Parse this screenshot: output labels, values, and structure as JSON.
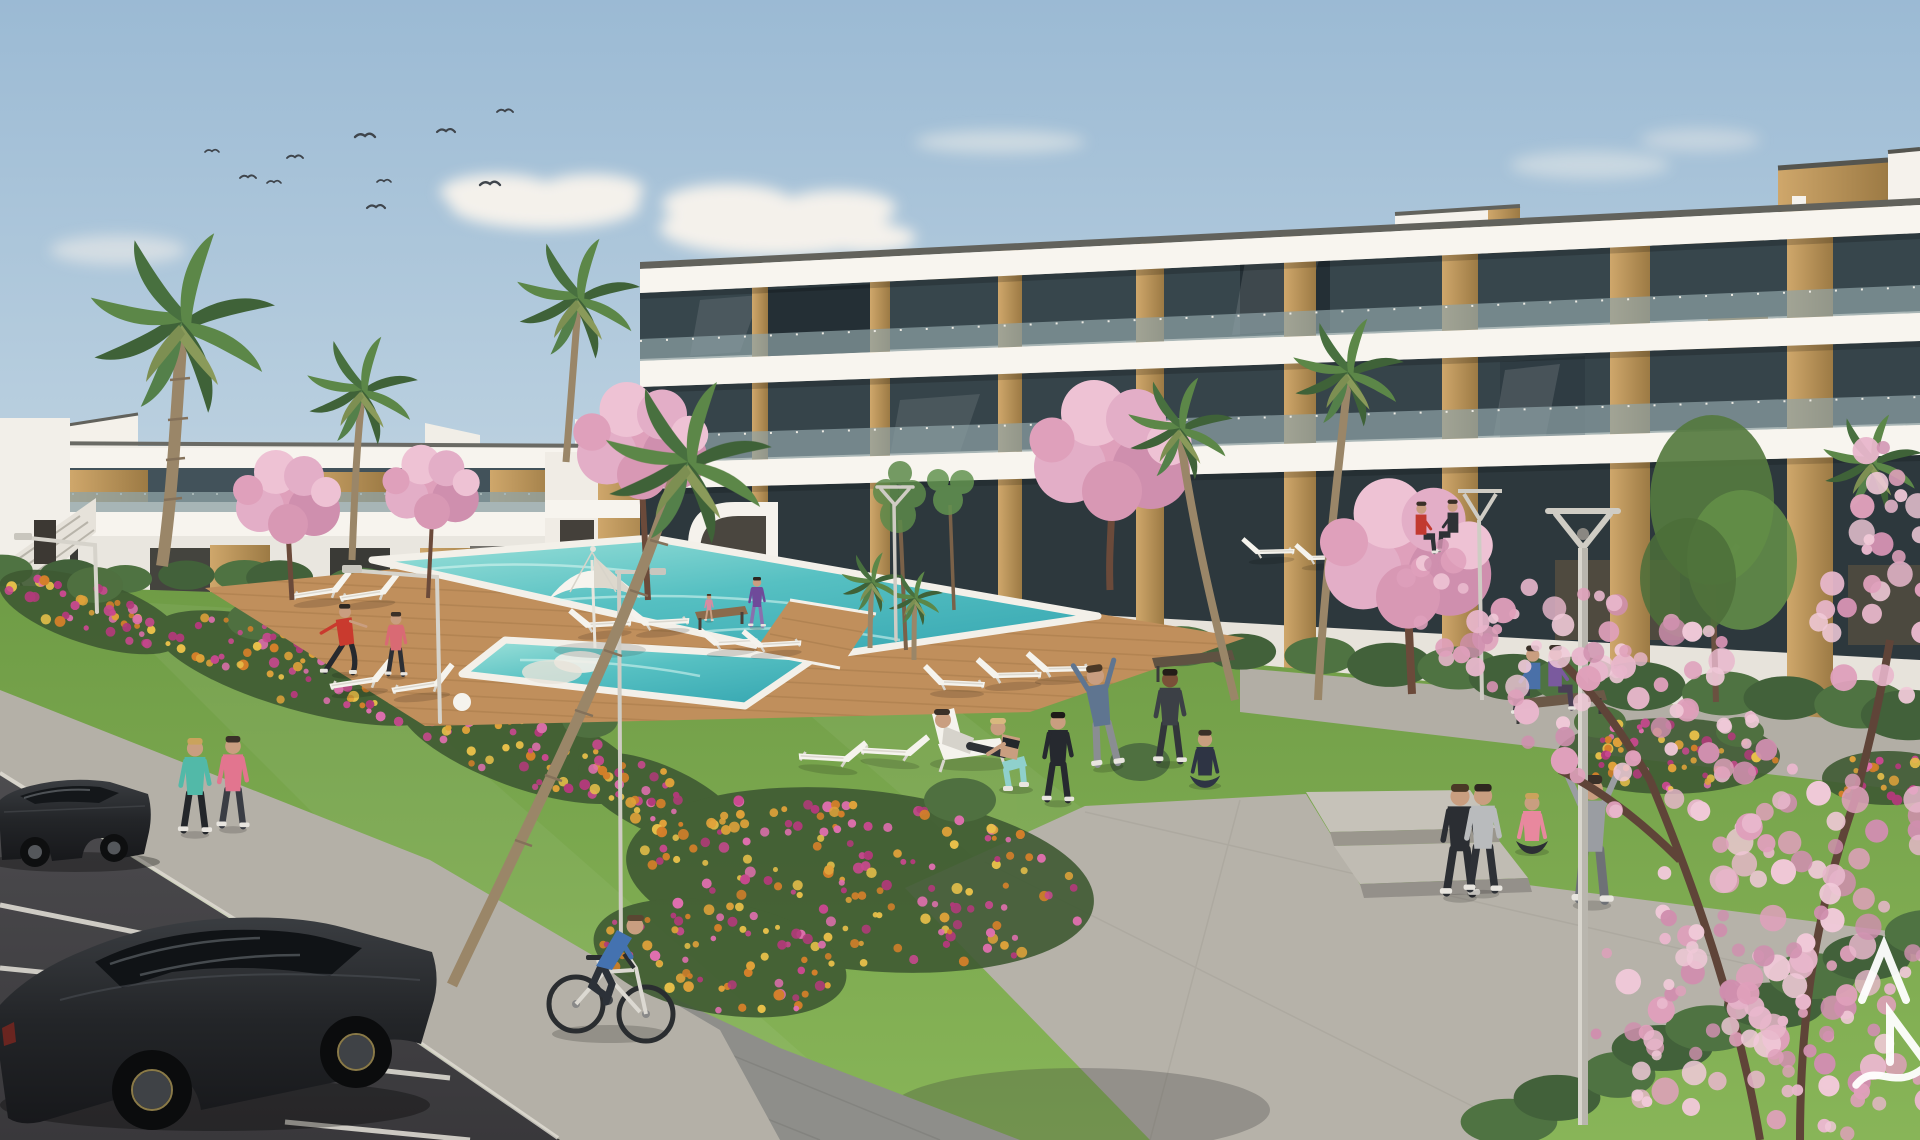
{
  "meta": {
    "type": "architectural_exterior_render",
    "subject": "Modern white apartment complex with communal pool, lawns, flower beds and parking, daytime 3D visualization"
  },
  "watermark": {
    "letters": "AN",
    "letter_a": "A",
    "letter_n": "N",
    "note": "white developer logo, cropped at right edge, with wave swoosh"
  },
  "palette": {
    "sky_top": "#9bbad4",
    "sky_mid": "#c3d6e4",
    "sky_low": "#e5e4da",
    "cloud": "#f4f1eb",
    "building_white": "#f6f3ee",
    "building_shade": "#dcd8d0",
    "coping_dark": "#62625c",
    "wood": "#c6a066",
    "wood_dark": "#9c7a44",
    "glass": "#37464c",
    "glass_dark": "#232e34",
    "balustrade": "#8fa3a6",
    "lawn_top": "#6f9c46",
    "lawn_bottom": "#85b355",
    "hedge_a": "#42613a",
    "hedge_b": "#4f7342",
    "palm_dark": "#3f6238",
    "palm_light": "#5c8748",
    "blossom": "#e3aec7",
    "pool_light": "#9fe2da",
    "pool_deep": "#39a9b3",
    "deck": "#c08f5c",
    "path": "#b4b0a7",
    "paver": "#8e8e8a",
    "asphalt": "#464548",
    "car_body": "#232528",
    "flower_colors": [
      "#c9488f",
      "#d4802a",
      "#e0a23a",
      "#df6fae",
      "#b23a7a",
      "#e8c04a"
    ],
    "blossom_colors": [
      "#e8b7cc",
      "#dfa0bb",
      "#f0c9d8",
      "#cf8fae"
    ]
  },
  "scene": {
    "buildings": {
      "right_block_floors": 3,
      "left_block_floors": 2,
      "features": [
        "white fascia bands",
        "glass balcony balustrades",
        "timber cladding piers",
        "rooftop stair towers",
        "crow-step details"
      ]
    },
    "amenities": [
      "swimming pool",
      "timber sun deck",
      "sun loungers",
      "parasol",
      "benches",
      "street lamps",
      "flower beds",
      "palm trees",
      "cherry blossom trees",
      "parking bays"
    ],
    "people_count": 21,
    "cars_count": 2,
    "birds_count": 10
  }
}
